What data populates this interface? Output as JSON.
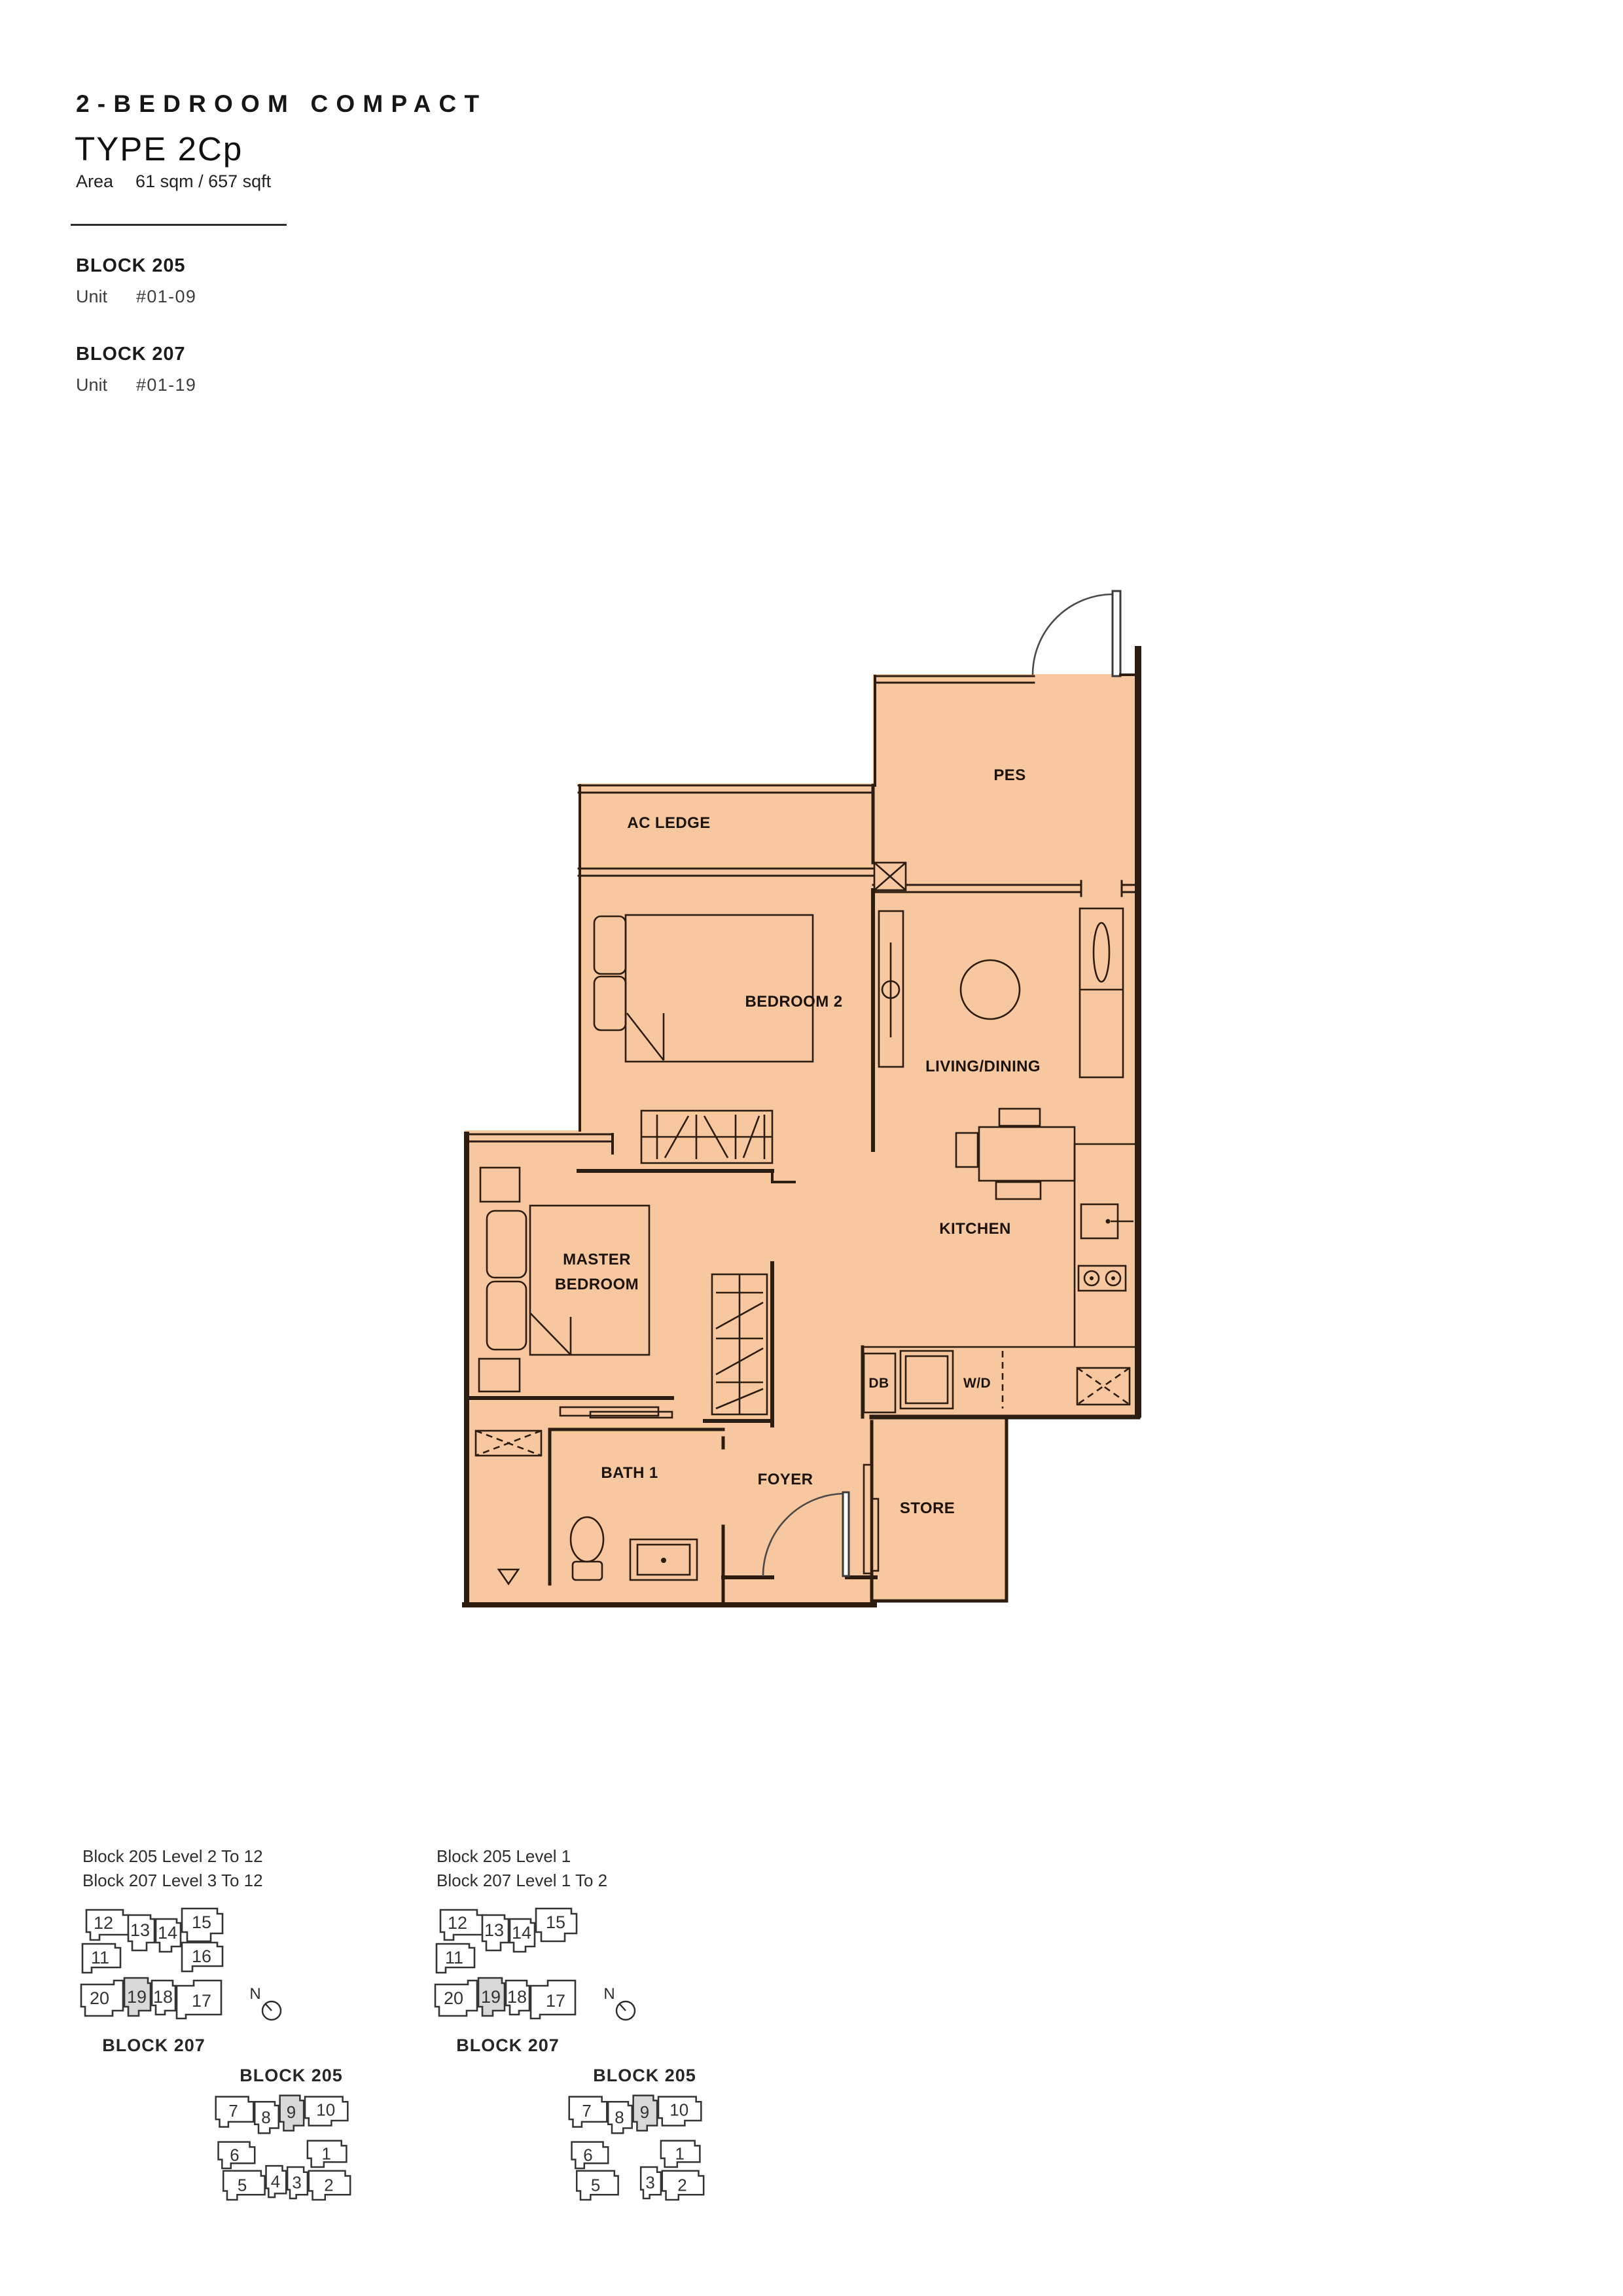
{
  "header": {
    "category_title": "2-BEDROOM COMPACT",
    "type_title": "TYPE 2Cp",
    "area_label": "Area",
    "area_value": "61 sqm / 657 sqft"
  },
  "blocks": [
    {
      "name": "BLOCK 205",
      "unit_label": "Unit",
      "unit_value": "#01-09"
    },
    {
      "name": "BLOCK 207",
      "unit_label": "Unit",
      "unit_value": "#01-19"
    }
  ],
  "floorplan": {
    "colors": {
      "floor": "#f7c79f",
      "wall": "#2d1c10",
      "keyplan_highlight": "#d8d8d8"
    },
    "rooms": {
      "pes": "PES",
      "ac_ledge": "AC LEDGE",
      "bedroom2": "BEDROOM 2",
      "living_dining": "LIVING/DINING",
      "master_line1": "MASTER",
      "master_line2": "BEDROOM",
      "kitchen": "KITCHEN",
      "bath1": "BATH 1",
      "foyer": "FOYER",
      "store": "STORE",
      "db": "DB",
      "wd": "W/D"
    }
  },
  "keyplans": {
    "compass_label": "N",
    "left": {
      "levels": [
        "Block 205 Level 2 To 12",
        "Block 207 Level 3 To 12"
      ],
      "block207": {
        "caption": "BLOCK 207",
        "highlighted_unit": "19",
        "units": [
          {
            "label": "12"
          },
          {
            "label": "13"
          },
          {
            "label": "14"
          },
          {
            "label": "15"
          },
          {
            "label": "11"
          },
          {
            "label": "16"
          },
          {
            "label": "20"
          },
          {
            "label": "19",
            "highlighted": true
          },
          {
            "label": "18"
          },
          {
            "label": "17"
          }
        ]
      },
      "block205": {
        "caption": "BLOCK 205",
        "highlighted_unit": "9",
        "units": [
          {
            "label": "7"
          },
          {
            "label": "8"
          },
          {
            "label": "9",
            "highlighted": true
          },
          {
            "label": "10"
          },
          {
            "label": "6"
          },
          {
            "label": "1"
          },
          {
            "label": "5"
          },
          {
            "label": "4"
          },
          {
            "label": "3"
          },
          {
            "label": "2"
          }
        ]
      }
    },
    "right": {
      "levels": [
        "Block 205 Level 1",
        "Block 207 Level 1 To 2"
      ],
      "block207": {
        "caption": "BLOCK 207",
        "highlighted_unit": "19",
        "units": [
          {
            "label": "12"
          },
          {
            "label": "13"
          },
          {
            "label": "14"
          },
          {
            "label": "15"
          },
          {
            "label": "11"
          },
          {
            "label": "20"
          },
          {
            "label": "19",
            "highlighted": true
          },
          {
            "label": "18"
          },
          {
            "label": "17"
          }
        ]
      },
      "block205": {
        "caption": "BLOCK 205",
        "highlighted_unit": "9",
        "units": [
          {
            "label": "7"
          },
          {
            "label": "8"
          },
          {
            "label": "9",
            "highlighted": true
          },
          {
            "label": "10"
          },
          {
            "label": "6"
          },
          {
            "label": "1"
          },
          {
            "label": "5"
          },
          {
            "label": "3"
          },
          {
            "label": "2"
          }
        ]
      }
    }
  }
}
